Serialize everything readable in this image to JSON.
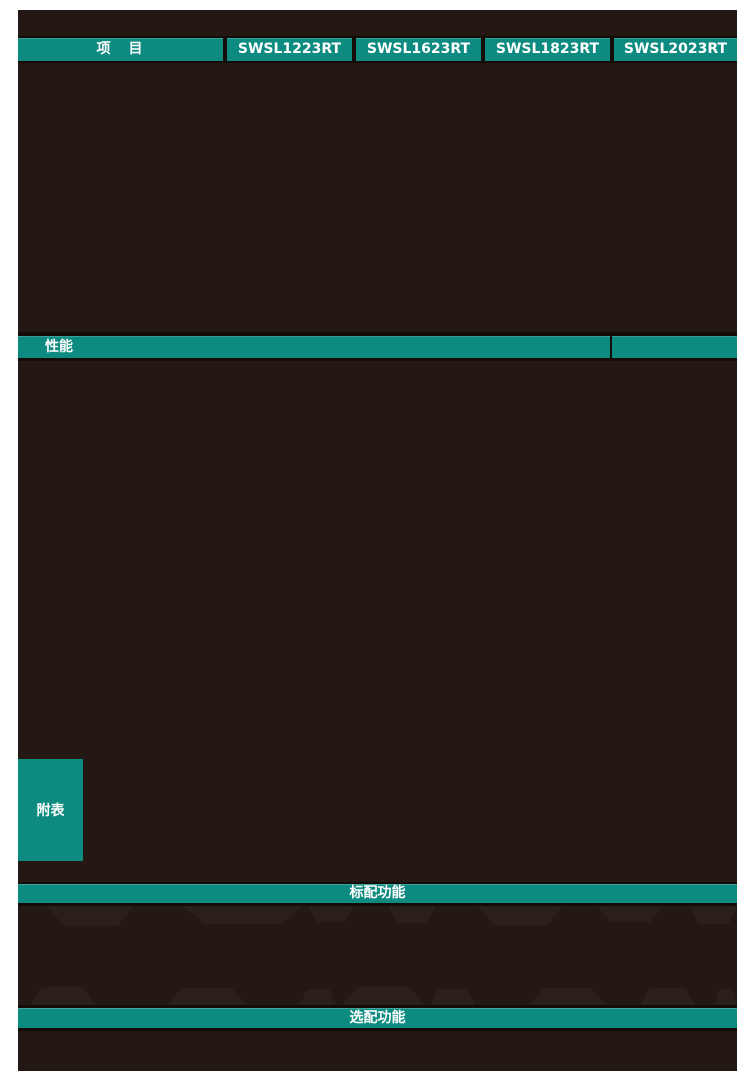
{
  "colors": {
    "accent_teal": "#0e8b80",
    "content_background": "#231814",
    "divider_dark": "#140c09",
    "page_margin": "#ffffff",
    "bar_text": "#ffffff"
  },
  "spec_table": {
    "item_column_label": "项　目",
    "model_columns": [
      "SWSL1223RT",
      "SWSL1623RT",
      "SWSL1823RT",
      "SWSL2023RT"
    ]
  },
  "sections": {
    "performance": {
      "label": "性能"
    },
    "appendix": {
      "label": "附表"
    },
    "standard_features": {
      "label": "标配功能"
    },
    "optional_features": {
      "label": "选配功能"
    }
  }
}
